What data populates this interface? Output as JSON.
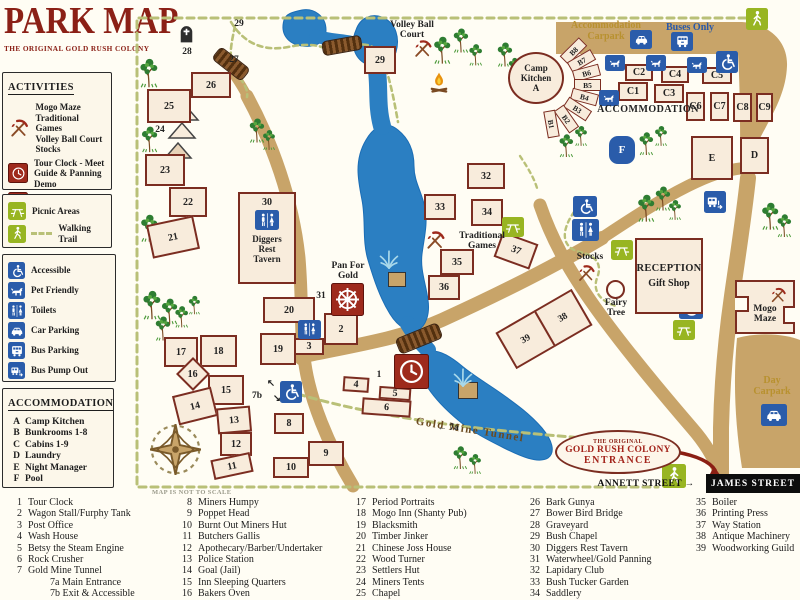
{
  "title": {
    "main": "PARK MAP",
    "subtitle": "THE ORIGINAL GOLD RUSH COLONY"
  },
  "sidebar": {
    "activities": {
      "header": "ACTIVITIES",
      "items": [
        {
          "icon": "pick",
          "bg": "none",
          "text": "Mogo Maze\nTraditional Games\nVolley Ball Court\nStocks"
        },
        {
          "icon": "clock",
          "bg": "red",
          "text": "Tour Clock - Meet\nGuide & Panning Demo"
        },
        {
          "icon": "wheel",
          "bg": "red",
          "text": "Pan for Gold"
        }
      ]
    },
    "trail": {
      "picnic": "Picnic Areas",
      "walking": "Walking Trail"
    },
    "facilities": [
      {
        "icon": "wheelchair",
        "label": "Accessible"
      },
      {
        "icon": "dog",
        "label": "Pet Friendly"
      },
      {
        "icon": "toilets",
        "label": "Toilets"
      },
      {
        "icon": "car",
        "label": "Car Parking"
      },
      {
        "icon": "bus",
        "label": "Bus Parking"
      },
      {
        "icon": "buspump",
        "label": "Bus Pump Out"
      }
    ],
    "accommodation": {
      "header": "ACCOMMODATION",
      "items": [
        {
          "key": "A",
          "label": "Camp Kitchen"
        },
        {
          "key": "B",
          "label": "Bunkrooms 1-8"
        },
        {
          "key": "C",
          "label": "Cabins 1-9"
        },
        {
          "key": "D",
          "label": "Laundry"
        },
        {
          "key": "E",
          "label": "Night Manager"
        },
        {
          "key": "F",
          "label": "Pool"
        }
      ]
    }
  },
  "legend": {
    "note": "MAP IS NOT TO SCALE",
    "columns": [
      [
        {
          "n": "1",
          "t": "Tour Clock"
        },
        {
          "n": "2",
          "t": "Wagon Stall/Furphy Tank"
        },
        {
          "n": "3",
          "t": "Post Office"
        },
        {
          "n": "4",
          "t": "Wash House"
        },
        {
          "n": "5",
          "t": "Betsy the Steam Engine"
        },
        {
          "n": "6",
          "t": "Rock Crusher"
        },
        {
          "n": "7",
          "t": "Gold Mine Tunnel"
        },
        {
          "n": "",
          "t": "7a Main Entrance",
          "ind": 1
        },
        {
          "n": "",
          "t": "7b Exit & Accessible",
          "ind": 1
        }
      ],
      [
        {
          "n": "8",
          "t": "Miners Humpy"
        },
        {
          "n": "9",
          "t": "Poppet Head"
        },
        {
          "n": "10",
          "t": "Burnt Out Miners Hut"
        },
        {
          "n": "11",
          "t": "Butchers Gallis"
        },
        {
          "n": "12",
          "t": "Apothecary/Barber/Undertaker"
        },
        {
          "n": "13",
          "t": "Police Station"
        },
        {
          "n": "14",
          "t": "Goal (Jail)"
        },
        {
          "n": "15",
          "t": "Inn Sleeping Quarters"
        },
        {
          "n": "16",
          "t": "Bakers Oven"
        }
      ],
      [
        {
          "n": "17",
          "t": "Period Portraits"
        },
        {
          "n": "18",
          "t": "Mogo Inn (Shanty Pub)"
        },
        {
          "n": "19",
          "t": "Blacksmith"
        },
        {
          "n": "20",
          "t": "Timber Jinker"
        },
        {
          "n": "21",
          "t": "Chinese Joss House"
        },
        {
          "n": "22",
          "t": "Wood Turner"
        },
        {
          "n": "23",
          "t": "Settlers Hut"
        },
        {
          "n": "24",
          "t": "Miners Tents"
        },
        {
          "n": "25",
          "t": "Chapel"
        }
      ],
      [
        {
          "n": "26",
          "t": "Bark Gunya"
        },
        {
          "n": "27",
          "t": "Bower Bird Bridge"
        },
        {
          "n": "28",
          "t": "Graveyard"
        },
        {
          "n": "29",
          "t": "Bush Chapel"
        },
        {
          "n": "30",
          "t": "Diggers Rest Tavern"
        },
        {
          "n": "31",
          "t": "Waterwheel/Gold Panning"
        },
        {
          "n": "32",
          "t": "Lapidary Club"
        },
        {
          "n": "33",
          "t": "Bush Tucker Garden"
        },
        {
          "n": "34",
          "t": "Saddlery"
        }
      ],
      [
        {
          "n": "35",
          "t": "Boiler"
        },
        {
          "n": "36",
          "t": "Printing Press"
        },
        {
          "n": "37",
          "t": "Way Station"
        },
        {
          "n": "38",
          "t": "Antique Machinery"
        },
        {
          "n": "39",
          "t": "Woodworking Guild"
        }
      ]
    ]
  },
  "map": {
    "special": {
      "camp_kitchen": "Camp\nKitchen\nA",
      "reception1": "RECEPTION",
      "reception2": "Gift Shop",
      "maze": "Mogo\nMaze",
      "tavern_num": "30",
      "tavern": "Diggers\nRest\nTavern",
      "pool": "F",
      "combo_left": "39",
      "combo_right": "38",
      "entrance1": "THE ORIGINAL",
      "entrance2": "GOLD RUSH COLONY",
      "entrance3": "ENTRANCE"
    },
    "street": {
      "james": "JAMES STREET"
    },
    "boxes": [
      {
        "n": "26",
        "x": 191,
        "y": 72,
        "w": 40,
        "h": 26
      },
      {
        "n": "25",
        "x": 147,
        "y": 89,
        "w": 44,
        "h": 34
      },
      {
        "n": "23",
        "x": 145,
        "y": 154,
        "w": 40,
        "h": 32
      },
      {
        "n": "22",
        "x": 169,
        "y": 187,
        "w": 38,
        "h": 30
      },
      {
        "n": "21",
        "x": 149,
        "y": 220,
        "w": 48,
        "h": 34,
        "r": -12
      },
      {
        "n": "17",
        "x": 164,
        "y": 337,
        "w": 34,
        "h": 30
      },
      {
        "n": "18",
        "x": 200,
        "y": 335,
        "w": 37,
        "h": 32
      },
      {
        "n": "16",
        "x": 181,
        "y": 362,
        "w": 24,
        "h": 24,
        "r": 45,
        "ur": 1
      },
      {
        "n": "15",
        "x": 208,
        "y": 375,
        "w": 36,
        "h": 30
      },
      {
        "n": "14",
        "x": 175,
        "y": 391,
        "w": 40,
        "h": 30,
        "r": -14
      },
      {
        "n": "13",
        "x": 217,
        "y": 407,
        "w": 34,
        "h": 26,
        "r": -5
      },
      {
        "n": "12",
        "x": 220,
        "y": 432,
        "w": 32,
        "h": 24
      },
      {
        "n": "11",
        "x": 212,
        "y": 456,
        "w": 40,
        "h": 20,
        "r": -12
      },
      {
        "n": "20",
        "x": 263,
        "y": 297,
        "w": 52,
        "h": 26
      },
      {
        "n": "19",
        "x": 260,
        "y": 333,
        "w": 36,
        "h": 32
      },
      {
        "n": "3",
        "x": 294,
        "y": 338,
        "w": 30,
        "h": 17
      },
      {
        "n": "2",
        "x": 324,
        "y": 313,
        "w": 34,
        "h": 32
      },
      {
        "n": "8",
        "x": 274,
        "y": 413,
        "w": 30,
        "h": 21
      },
      {
        "n": "9",
        "x": 308,
        "y": 441,
        "w": 36,
        "h": 25
      },
      {
        "n": "10",
        "x": 273,
        "y": 457,
        "w": 36,
        "h": 21
      },
      {
        "n": "4",
        "x": 343,
        "y": 377,
        "w": 26,
        "h": 15,
        "r": 4
      },
      {
        "n": "5",
        "x": 379,
        "y": 387,
        "w": 32,
        "h": 13,
        "r": 4
      },
      {
        "n": "6",
        "x": 362,
        "y": 399,
        "w": 49,
        "h": 17,
        "r": 4
      },
      {
        "n": "33",
        "x": 424,
        "y": 194,
        "w": 32,
        "h": 26
      },
      {
        "n": "34",
        "x": 471,
        "y": 199,
        "w": 32,
        "h": 27
      },
      {
        "n": "35",
        "x": 440,
        "y": 249,
        "w": 34,
        "h": 26
      },
      {
        "n": "36",
        "x": 428,
        "y": 275,
        "w": 32,
        "h": 25
      },
      {
        "n": "32",
        "x": 467,
        "y": 163,
        "w": 38,
        "h": 26
      },
      {
        "n": "37",
        "x": 497,
        "y": 237,
        "w": 38,
        "h": 27,
        "r": 20
      },
      {
        "n": "29",
        "x": 364,
        "y": 46,
        "w": 32,
        "h": 28
      },
      {
        "n": "E",
        "x": 691,
        "y": 136,
        "w": 42,
        "h": 44
      },
      {
        "n": "D",
        "x": 740,
        "y": 137,
        "w": 29,
        "h": 37
      },
      {
        "n": "C1",
        "x": 618,
        "y": 82,
        "w": 30,
        "h": 19
      },
      {
        "n": "C2",
        "x": 625,
        "y": 64,
        "w": 28,
        "h": 17
      },
      {
        "n": "C3",
        "x": 654,
        "y": 84,
        "w": 30,
        "h": 19
      },
      {
        "n": "C4",
        "x": 661,
        "y": 66,
        "w": 28,
        "h": 17
      },
      {
        "n": "C5",
        "x": 702,
        "y": 67,
        "w": 30,
        "h": 17
      },
      {
        "n": "C6",
        "x": 686,
        "y": 92,
        "w": 19,
        "h": 29
      },
      {
        "n": "C7",
        "x": 710,
        "y": 92,
        "w": 19,
        "h": 29
      },
      {
        "n": "C8",
        "x": 733,
        "y": 93,
        "w": 19,
        "h": 29
      },
      {
        "n": "C9",
        "x": 756,
        "y": 93,
        "w": 17,
        "h": 29
      },
      {
        "n": "",
        "x": 388,
        "y": 272,
        "w": 18,
        "h": 15,
        "cls": "plat"
      },
      {
        "n": "",
        "x": 458,
        "y": 382,
        "w": 20,
        "h": 17,
        "cls": "plat"
      }
    ],
    "fan": [
      {
        "n": "B8",
        "x": 573,
        "y": 51,
        "r": -45
      },
      {
        "n": "B7",
        "x": 581,
        "y": 61,
        "r": -30
      },
      {
        "n": "B6",
        "x": 586,
        "y": 73,
        "r": -15
      },
      {
        "n": "B5",
        "x": 587,
        "y": 85,
        "r": 0
      },
      {
        "n": "B4",
        "x": 584,
        "y": 97,
        "r": 15
      },
      {
        "n": "B3",
        "x": 577,
        "y": 109,
        "r": 33
      },
      {
        "n": "B2",
        "x": 566,
        "y": 119,
        "r": 55
      },
      {
        "n": "B1",
        "x": 551,
        "y": 124,
        "r": 80
      }
    ],
    "tiles": [
      {
        "i": "walker",
        "x": 746,
        "y": 8,
        "w": 22,
        "h": 22,
        "bg": "g"
      },
      {
        "i": "walker",
        "x": 662,
        "y": 464,
        "w": 24,
        "h": 24,
        "bg": "g"
      },
      {
        "i": "car",
        "x": 630,
        "y": 30,
        "w": 22,
        "h": 19,
        "bg": "b"
      },
      {
        "i": "bus",
        "x": 671,
        "y": 32,
        "w": 22,
        "h": 19,
        "bg": "b"
      },
      {
        "i": "dog",
        "x": 605,
        "y": 55,
        "w": 20,
        "h": 16,
        "bg": "b"
      },
      {
        "i": "dog",
        "x": 646,
        "y": 55,
        "w": 20,
        "h": 16,
        "bg": "b"
      },
      {
        "i": "dog",
        "x": 687,
        "y": 57,
        "w": 20,
        "h": 16,
        "bg": "b"
      },
      {
        "i": "wheelchair",
        "x": 716,
        "y": 51,
        "w": 22,
        "h": 22,
        "bg": "b"
      },
      {
        "i": "dog",
        "x": 599,
        "y": 90,
        "w": 20,
        "h": 16,
        "bg": "b"
      },
      {
        "i": "buspump",
        "x": 704,
        "y": 191,
        "w": 22,
        "h": 22,
        "bg": "b"
      },
      {
        "i": "wheelchair",
        "x": 573,
        "y": 196,
        "w": 24,
        "h": 21,
        "bg": "b"
      },
      {
        "i": "toilets",
        "x": 572,
        "y": 219,
        "w": 27,
        "h": 22,
        "bg": "b"
      },
      {
        "i": "toilets",
        "x": 298,
        "y": 320,
        "w": 23,
        "h": 19,
        "bg": "b"
      },
      {
        "i": "wheelchair",
        "x": 280,
        "y": 381,
        "w": 22,
        "h": 22,
        "bg": "b"
      },
      {
        "i": "wheelchair",
        "x": 679,
        "y": 295,
        "w": 24,
        "h": 24,
        "bg": "b"
      },
      {
        "i": "picnic",
        "x": 502,
        "y": 217,
        "w": 22,
        "h": 20,
        "bg": "g"
      },
      {
        "i": "picnic",
        "x": 611,
        "y": 240,
        "w": 22,
        "h": 20,
        "bg": "g"
      },
      {
        "i": "picnic",
        "x": 673,
        "y": 320,
        "w": 22,
        "h": 20,
        "bg": "g"
      },
      {
        "i": "car",
        "x": 761,
        "y": 404,
        "w": 26,
        "h": 22,
        "bg": "b"
      },
      {
        "i": "clock",
        "x": 394,
        "y": 354,
        "w": 33,
        "h": 33,
        "bg": "r"
      },
      {
        "i": "wheel",
        "x": 331,
        "y": 283,
        "w": 31,
        "h": 31,
        "bg": "r"
      },
      {
        "i": "grave",
        "x": 176,
        "y": 20,
        "w": 21,
        "h": 27,
        "bg": "n"
      },
      {
        "i": "fire",
        "x": 426,
        "y": 68,
        "w": 26,
        "h": 29,
        "bg": "n"
      },
      {
        "i": "pick",
        "x": 412,
        "y": 38,
        "w": 21,
        "h": 21,
        "bg": "n"
      },
      {
        "i": "pick",
        "x": 424,
        "y": 229,
        "w": 22,
        "h": 22,
        "bg": "n"
      },
      {
        "i": "pick",
        "x": 576,
        "y": 263,
        "w": 20,
        "h": 20,
        "bg": "n"
      },
      {
        "i": "compass",
        "x": 148,
        "y": 422,
        "w": 55,
        "h": 55,
        "bg": "n"
      },
      {
        "i": "fountain",
        "x": 376,
        "y": 246,
        "w": 26,
        "h": 26,
        "bg": "n"
      },
      {
        "i": "fountain",
        "x": 450,
        "y": 364,
        "w": 26,
        "h": 26,
        "bg": "n"
      }
    ],
    "trees": [
      {
        "x": 136,
        "y": 56,
        "s": 1
      },
      {
        "x": 148,
        "y": 90,
        "s": 0.85
      },
      {
        "x": 138,
        "y": 124,
        "s": 0.9
      },
      {
        "x": 137,
        "y": 212,
        "s": 0.95
      },
      {
        "x": 139,
        "y": 288,
        "s": 1
      },
      {
        "x": 152,
        "y": 314,
        "s": 0.85
      },
      {
        "x": 158,
        "y": 296,
        "s": 0.9
      },
      {
        "x": 172,
        "y": 304,
        "s": 0.75
      },
      {
        "x": 186,
        "y": 294,
        "s": 0.65
      },
      {
        "x": 246,
        "y": 116,
        "s": 0.85
      },
      {
        "x": 260,
        "y": 128,
        "s": 0.7
      },
      {
        "x": 430,
        "y": 34,
        "s": 0.95
      },
      {
        "x": 450,
        "y": 26,
        "s": 0.85
      },
      {
        "x": 466,
        "y": 42,
        "s": 0.75
      },
      {
        "x": 494,
        "y": 40,
        "s": 0.85
      },
      {
        "x": 506,
        "y": 56,
        "s": 0.65
      },
      {
        "x": 556,
        "y": 132,
        "s": 0.8
      },
      {
        "x": 572,
        "y": 124,
        "s": 0.7
      },
      {
        "x": 636,
        "y": 130,
        "s": 0.8
      },
      {
        "x": 652,
        "y": 124,
        "s": 0.7
      },
      {
        "x": 634,
        "y": 192,
        "s": 0.95
      },
      {
        "x": 652,
        "y": 184,
        "s": 0.85
      },
      {
        "x": 666,
        "y": 198,
        "s": 0.7
      },
      {
        "x": 758,
        "y": 200,
        "s": 0.95
      },
      {
        "x": 774,
        "y": 212,
        "s": 0.8
      },
      {
        "x": 450,
        "y": 444,
        "s": 0.8
      },
      {
        "x": 466,
        "y": 452,
        "s": 0.7
      }
    ],
    "labels": [
      {
        "t": "Volley Ball\nCourt",
        "x": 412,
        "y": 20,
        "c": "name"
      },
      {
        "t": "Accommodation\nCarpark",
        "x": 606,
        "y": 21,
        "c": "gold"
      },
      {
        "t": "Buses Only",
        "x": 690,
        "y": 23,
        "c": "blueb"
      },
      {
        "t": "ACCOMMODATION",
        "x": 648,
        "y": 105,
        "c": "caps"
      },
      {
        "t": "Traditional\nGames",
        "x": 482,
        "y": 231,
        "c": "name"
      },
      {
        "t": "Pan For\nGold",
        "x": 348,
        "y": 261,
        "c": "name"
      },
      {
        "t": "Stocks",
        "x": 590,
        "y": 252,
        "c": "name"
      },
      {
        "t": "Fairy\nTree",
        "x": 616,
        "y": 298,
        "c": "name"
      },
      {
        "t": "Day\nCarpark",
        "x": 772,
        "y": 376,
        "c": "gold"
      },
      {
        "t": "Gold Mine Tunnel",
        "x": 470,
        "y": 425,
        "c": "tunnel",
        "r": 9
      },
      {
        "t": "ANNETT STREET →",
        "x": 646,
        "y": 479,
        "c": "street"
      },
      {
        "t": "29",
        "x": 239,
        "y": 19,
        "c": "num"
      },
      {
        "t": "27",
        "x": 234,
        "y": 55,
        "c": "num"
      },
      {
        "t": "28",
        "x": 187,
        "y": 47,
        "c": "num"
      },
      {
        "t": "24",
        "x": 160,
        "y": 125,
        "c": "num"
      },
      {
        "t": "31",
        "x": 321,
        "y": 291,
        "c": "num"
      },
      {
        "t": "1",
        "x": 379,
        "y": 370,
        "c": "num"
      },
      {
        "t": "7b",
        "x": 257,
        "y": 391,
        "c": "num"
      },
      {
        "t": "↖",
        "x": 271,
        "y": 379,
        "c": "num"
      },
      {
        "t": "↘",
        "x": 277,
        "y": 394,
        "c": "num"
      },
      {
        "t": "← 7a",
        "x": 448,
        "y": 423,
        "c": "num"
      }
    ]
  }
}
